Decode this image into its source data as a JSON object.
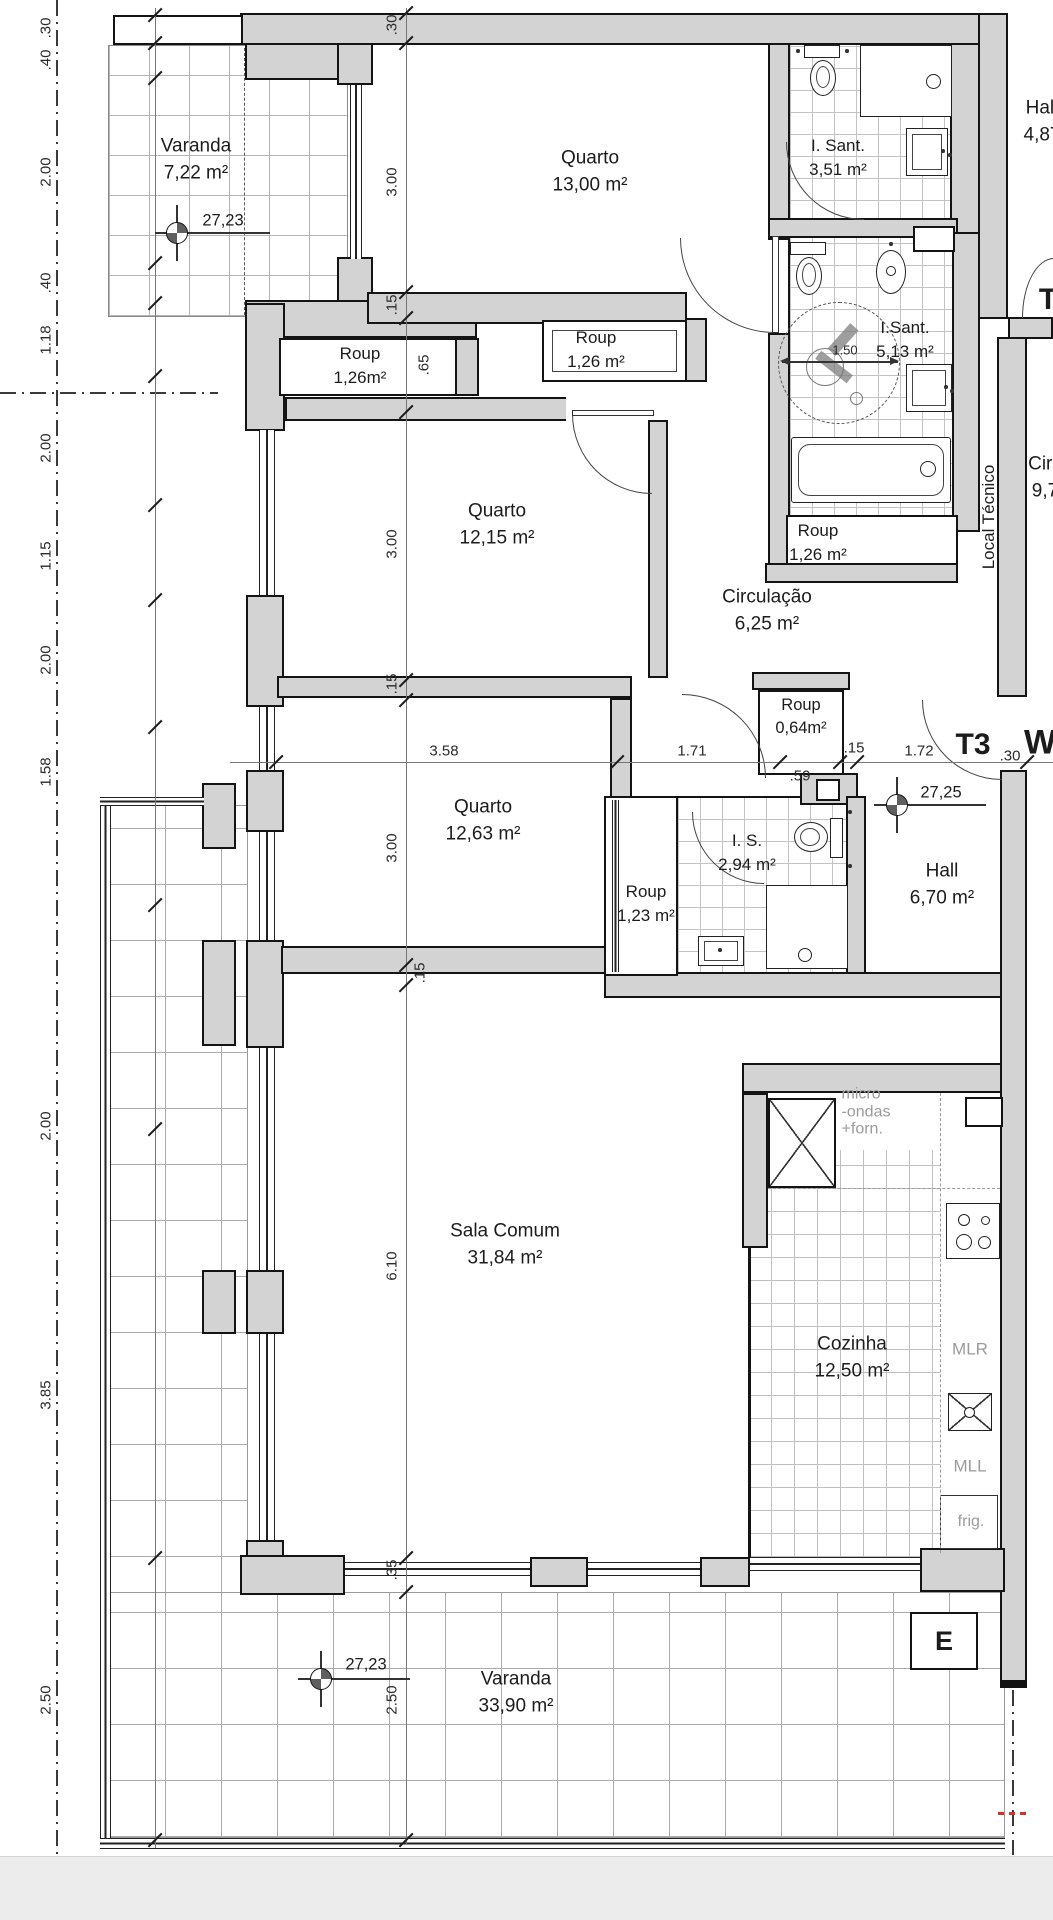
{
  "unit": {
    "t3": "T3",
    "w": "W",
    "t_fragment": "T"
  },
  "rooms": [
    {
      "name": "Varanda",
      "area": "7,22 m²"
    },
    {
      "name": "Quarto",
      "area": "13,00 m²"
    },
    {
      "name": "I. Sant.",
      "area": "3,51 m²"
    },
    {
      "name": "Hall",
      "area": "4,87"
    },
    {
      "name": "Roup",
      "area": "1,26m²"
    },
    {
      "name": "Roup",
      "area": "1,26 m²"
    },
    {
      "name": "I.Sant.",
      "area": "5,13 m²"
    },
    {
      "name": "Quarto",
      "area": "12,15 m²"
    },
    {
      "name": "Roup",
      "area": "1,26 m²"
    },
    {
      "name": "Circulação",
      "area": "6,25 m²"
    },
    {
      "name": "Circ",
      "area": "9,7"
    },
    {
      "name": "Local Técnico",
      "area": ""
    },
    {
      "name": "Roup",
      "area": "0,64m²"
    },
    {
      "name": "Quarto",
      "area": "12,63 m²"
    },
    {
      "name": "I. S.",
      "area": "2,94 m²"
    },
    {
      "name": "Roup",
      "area": "1,23 m²"
    },
    {
      "name": "Hall",
      "area": "6,70 m²"
    },
    {
      "name": "Sala Comum",
      "area": "31,84 m²"
    },
    {
      "name": "Cozinha",
      "area": "12,50 m²"
    },
    {
      "name": "Varanda",
      "area": "33,90 m²"
    }
  ],
  "levels": {
    "top": "27,23",
    "mid": "27,25",
    "bottom": "27,23"
  },
  "kitchen": {
    "micro_l1": "micro",
    "micro_l2": "-ondas",
    "micro_l3": "+forn.",
    "mlr": "MLR",
    "mll": "MLL",
    "frig": "frig.",
    "elevator": "E"
  },
  "dims": {
    "left": [
      ".30",
      ".40",
      "2.00",
      ".40",
      "1.18",
      "2.00",
      "1.15",
      "2.00",
      "1.58",
      "2.00",
      "3.85",
      "2.50"
    ],
    "center": [
      ".30",
      "3.00",
      ".15",
      ".65",
      "3.00",
      ".15",
      "3.00",
      ".15",
      "6.10",
      ".35",
      "2.50"
    ],
    "horizontal": [
      "3.58",
      "1.71",
      ".59",
      ".15",
      "1.72",
      ".30"
    ],
    "accessibility_radius": "1.50"
  }
}
